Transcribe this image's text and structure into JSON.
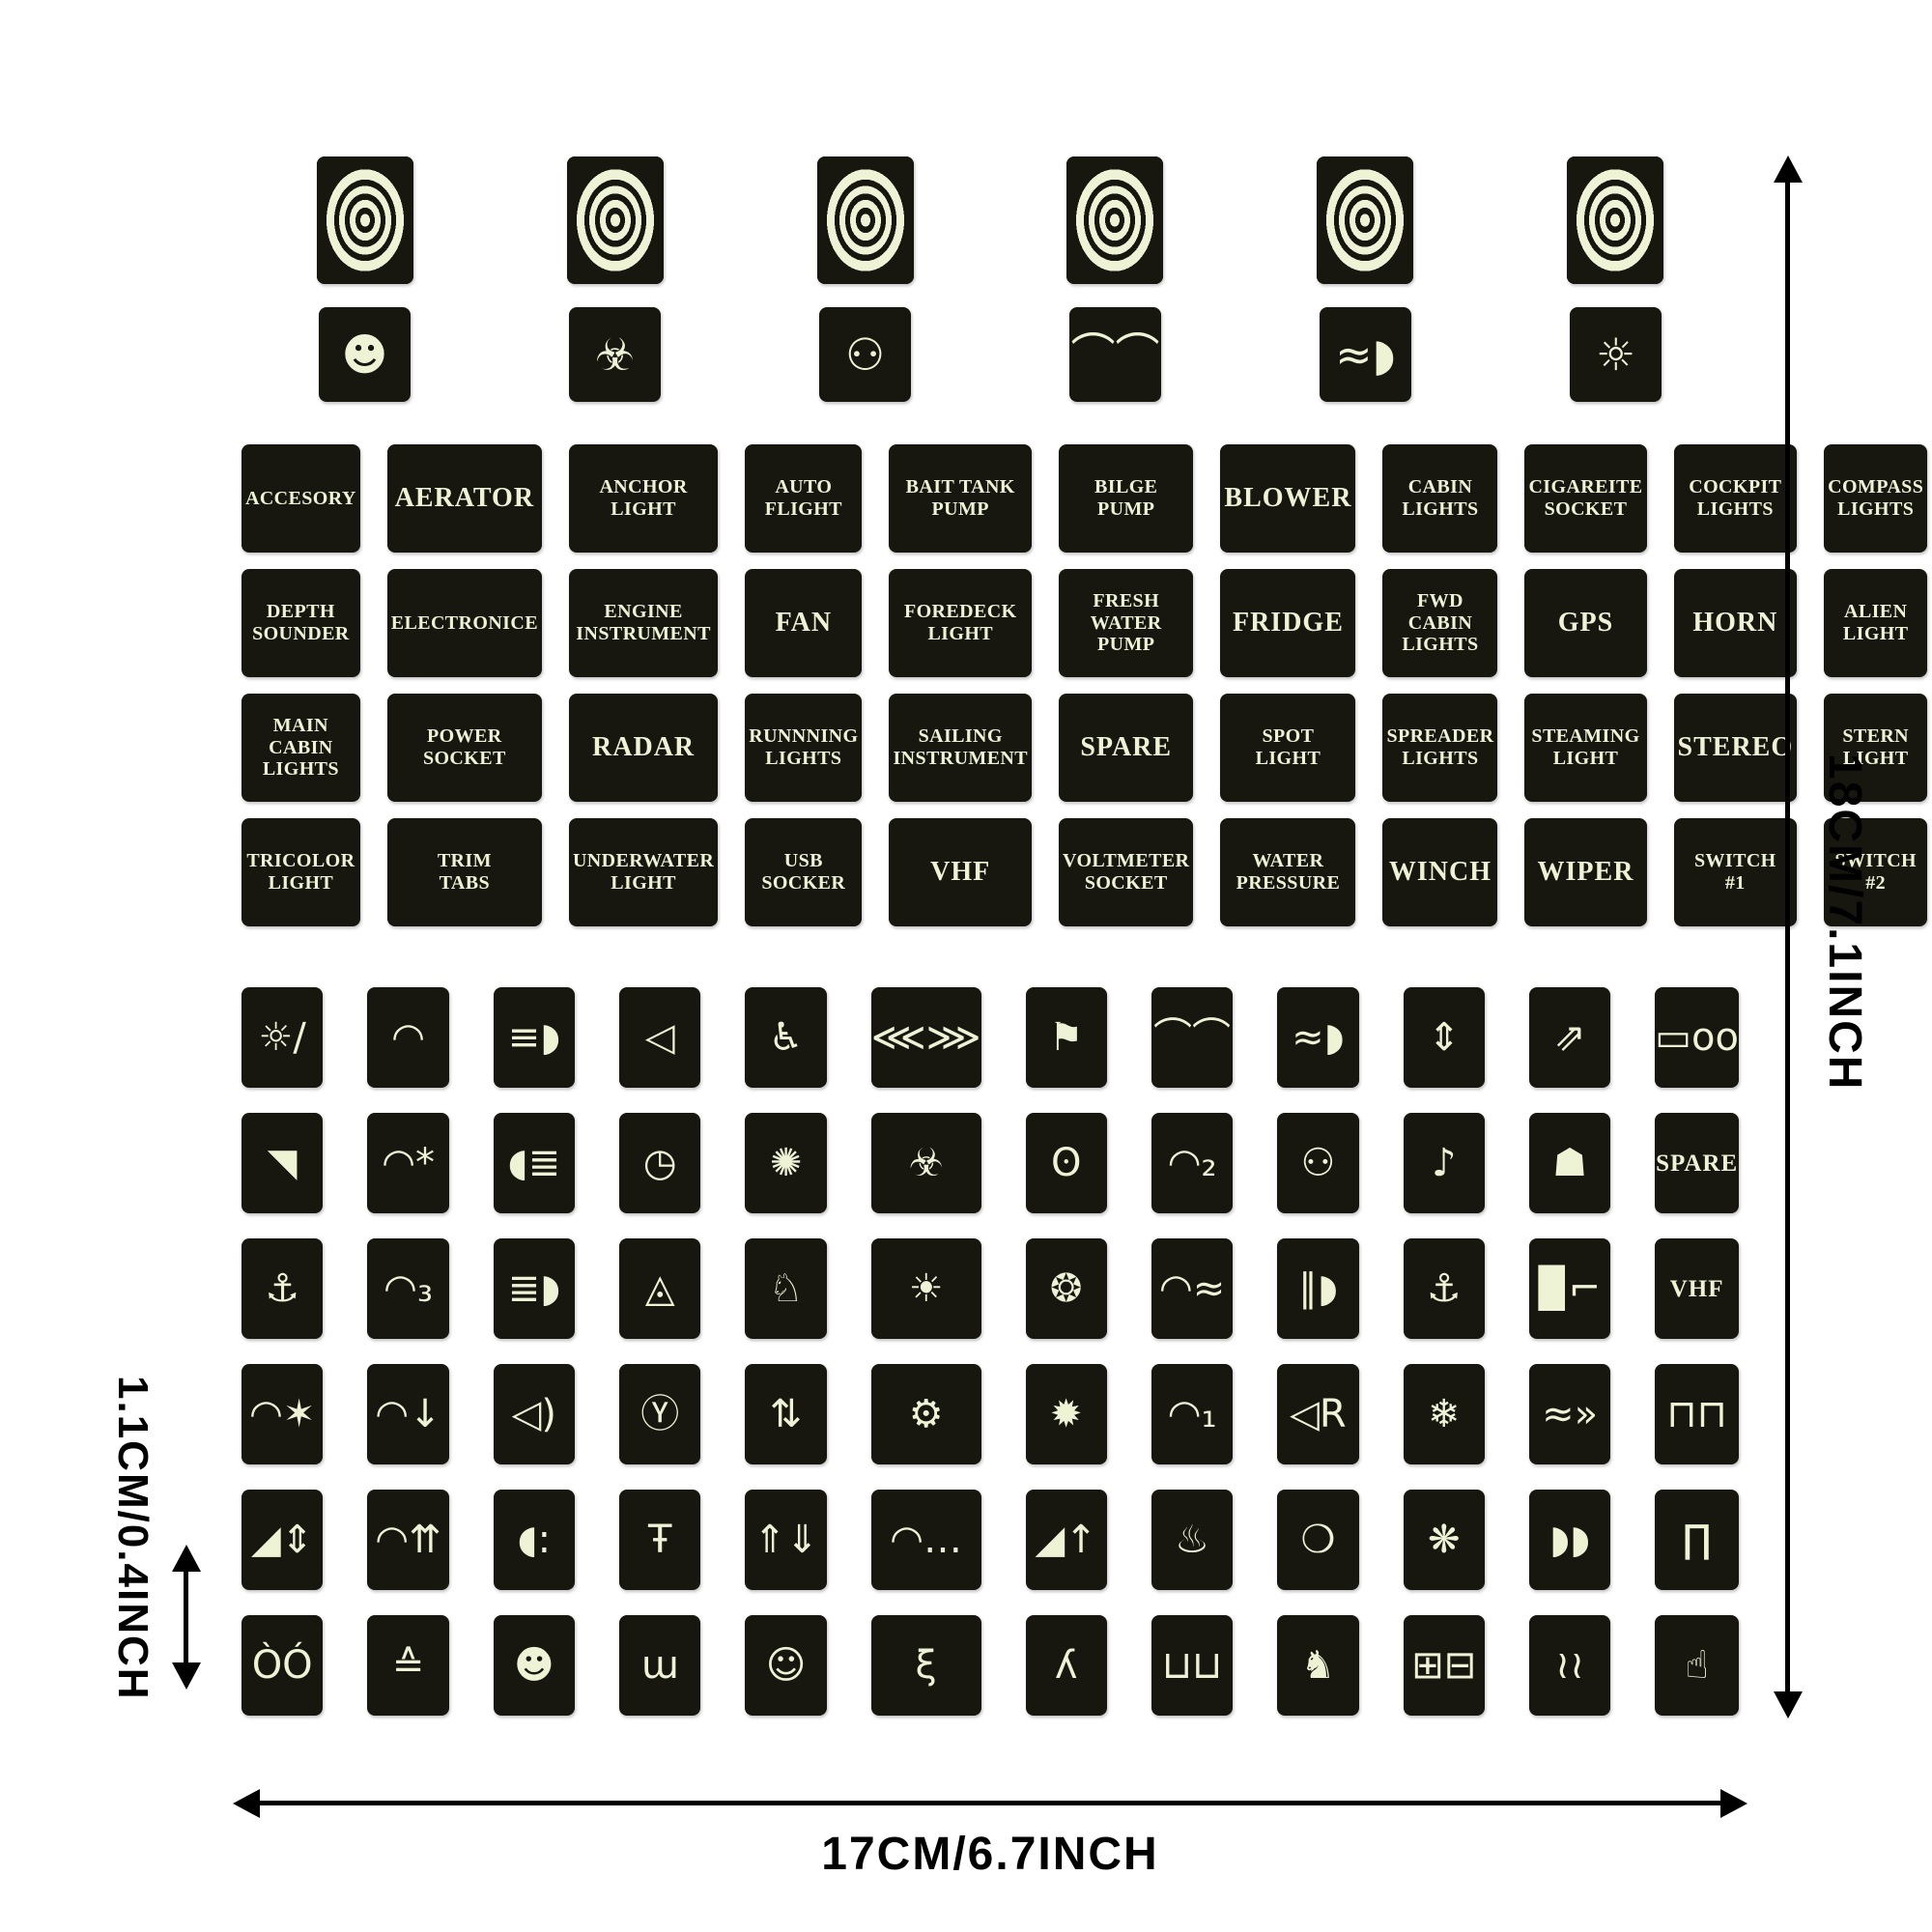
{
  "colors": {
    "background": "#ffffff",
    "sticker": "#171710",
    "glow": "#eef3d6",
    "annotation": "#000000"
  },
  "dims": {
    "height": "18CM/7.1INCH",
    "width": "17CM/6.7INCH",
    "cell": "1.1CM/0.4INCH"
  },
  "sheet": {
    "targets": [
      {
        "name": "bullseye-target-sticker"
      },
      {
        "name": "bullseye-target-sticker"
      },
      {
        "name": "bullseye-target-sticker"
      },
      {
        "name": "bullseye-target-sticker"
      },
      {
        "name": "bullseye-target-sticker"
      },
      {
        "name": "bullseye-target-sticker"
      }
    ],
    "novelty": [
      {
        "name": "gangster-face-icon",
        "glyph": "☻"
      },
      {
        "name": "biohazard-icon",
        "glyph": "☣"
      },
      {
        "name": "alien-icon",
        "glyph": "⚇"
      },
      {
        "name": "wiper-washer-icon",
        "glyph": "⌒⌒"
      },
      {
        "name": "fog-light-icon",
        "glyph": "≈◗"
      },
      {
        "name": "light-dial-icon",
        "glyph": "☼"
      }
    ],
    "labels": [
      "ACCESORY",
      "AERATOR",
      "ANCHOR\nLIGHT",
      "AUTO\nFLIGHT",
      "BAIT TANK\nPUMP",
      "BILGE\nPUMP",
      "BLOWER",
      "CABIN\nLIGHTS",
      "CIGAREITE\nSOCKET",
      "COCKPIT\nLIGHTS",
      "COMPASS\nLIGHTS",
      "DECK\nWASH",
      "DEPTH\nSOUNDER",
      "ELECTRONICE",
      "ENGINE\nINSTRUMENT",
      "FAN",
      "FOREDECK\nLIGHT",
      "FRESH WATER\nPUMP",
      "FRIDGE",
      "FWD CABIN\nLIGHTS",
      "GPS",
      "HORN",
      "ALIEN\nLIGHT",
      "MACERATOR\nPUMP",
      "MAIN CABIN\nLIGHTS",
      "POWER\nSOCKET",
      "RADAR",
      "RUNNNING\nLIGHTS",
      "SAILING\nINSTRUMENT",
      "SPARE",
      "SPOT\nLIGHT",
      "SPREADER\nLIGHTS",
      "STEAMING\nLIGHT",
      "STEREO",
      "STERN\nLIGHT",
      "STROBE\nLIGHT",
      "TRICOLOR\nLIGHT",
      "TRIM\nTABS",
      "UNDERWATER\nLIGHT",
      "USB\nSOCKER",
      "VHF",
      "VOLTMETER\nSOCKET",
      "WATER\nPRESSURE",
      "WINCH",
      "WIPER",
      "SWITCH\n#1",
      "SWITCH\n#2",
      "SWITCH\n#3"
    ],
    "icons": [
      {
        "name": "nav-lights-off-icon",
        "glyph": "☼∕"
      },
      {
        "name": "windshield-wiper-icon",
        "glyph": "◠"
      },
      {
        "name": "headlight-beam-icon",
        "glyph": "≡◗"
      },
      {
        "name": "speaker-icon",
        "glyph": "◁"
      },
      {
        "name": "wheelchair-icon",
        "glyph": "♿"
      },
      {
        "name": "wings-icon",
        "glyph": "⋘⋙"
      },
      {
        "name": "boat-flag-icon",
        "glyph": "⚑"
      },
      {
        "name": "wiper-spray-icon",
        "glyph": "⌒⌒"
      },
      {
        "name": "fog-light-icon",
        "glyph": "≈◗"
      },
      {
        "name": "trim-arrows-icon",
        "glyph": "⇕"
      },
      {
        "name": "outboard-tilt-icon",
        "glyph": "⇗"
      },
      {
        "name": "tow-truck-icon",
        "glyph": "▭oo"
      },
      {
        "name": "sonar-boat-icon",
        "glyph": "◥"
      },
      {
        "name": "wiper-washer-icon",
        "glyph": "◠*"
      },
      {
        "name": "lamp-check-icon",
        "glyph": "◖≣"
      },
      {
        "name": "gauge-icon",
        "glyph": "◷"
      },
      {
        "name": "beacon-icon",
        "glyph": "✺"
      },
      {
        "name": "biohazard-icon",
        "glyph": "☣"
      },
      {
        "name": "bulb-ring-icon",
        "glyph": "ʘ"
      },
      {
        "name": "wiper-delay-2-icon",
        "glyph": "◠₂"
      },
      {
        "name": "alien-icon",
        "glyph": "⚇"
      },
      {
        "name": "music-note-icon",
        "glyph": "♪"
      },
      {
        "name": "turtle-icon",
        "glyph": "☗"
      },
      {
        "name": "spare-text-sticker",
        "glyph": "SPARE",
        "text": true
      },
      {
        "name": "anchor-light-icon",
        "glyph": "⚓"
      },
      {
        "name": "wiper-delay-3-icon",
        "glyph": "◠₃"
      },
      {
        "name": "high-beam-icon",
        "glyph": "≣◗"
      },
      {
        "name": "hazard-triangle-icon",
        "glyph": "◬"
      },
      {
        "name": "rabbit-icon",
        "glyph": "♘"
      },
      {
        "name": "sun-light-icon",
        "glyph": "☀"
      },
      {
        "name": "spreader-light-icon",
        "glyph": "❂"
      },
      {
        "name": "wiper-washpump-icon",
        "glyph": "◠≈"
      },
      {
        "name": "driving-light-icon",
        "glyph": "∥◗"
      },
      {
        "name": "anchor-icon",
        "glyph": "⚓"
      },
      {
        "name": "fuel-pump-icon",
        "glyph": "▉⌐"
      },
      {
        "name": "vhf-text-sticker",
        "glyph": "VHF",
        "text": true
      },
      {
        "name": "grill-light-icon",
        "glyph": "◠✶"
      },
      {
        "name": "wiper-down-icon",
        "glyph": "◠↓"
      },
      {
        "name": "horn-icon",
        "glyph": "◁)"
      },
      {
        "name": "steering-wheel-icon",
        "glyph": "Ⓨ"
      },
      {
        "name": "fluid-level-icon",
        "glyph": "⇅"
      },
      {
        "name": "engine-piston-icon",
        "glyph": "⚙"
      },
      {
        "name": "bulb-rays-icon",
        "glyph": "✹"
      },
      {
        "name": "wiper-delay-1-icon",
        "glyph": "◠₁"
      },
      {
        "name": "air-horn-icon",
        "glyph": "◁R"
      },
      {
        "name": "snowflake-icon",
        "glyph": "❄"
      },
      {
        "name": "lights-fishing-icon",
        "glyph": "≈»"
      },
      {
        "name": "light-bar-icon",
        "glyph": "⊓⊓"
      },
      {
        "name": "boat-trim-icon",
        "glyph": "◢⇕"
      },
      {
        "name": "defroster-icon",
        "glyph": "◠⇈"
      },
      {
        "name": "flood-light-icon",
        "glyph": "◖:"
      },
      {
        "name": "faucet-icon",
        "glyph": "Ŧ"
      },
      {
        "name": "hatch-lift-icon",
        "glyph": "⇑⇓"
      },
      {
        "name": "dome-light-icon",
        "glyph": "◠…"
      },
      {
        "name": "boat-lift-icon",
        "glyph": "◢↑"
      },
      {
        "name": "cabin-heat-icon",
        "glyph": "♨"
      },
      {
        "name": "fog-lamp-down-icon",
        "glyph": "❍"
      },
      {
        "name": "fan-icon",
        "glyph": "❋"
      },
      {
        "name": "dual-headlights-icon",
        "glyph": "◗◗"
      },
      {
        "name": "arch-frame-icon",
        "glyph": "∏"
      },
      {
        "name": "angry-eyes-icon",
        "glyph": "ÒÓ"
      },
      {
        "name": "detective-icon",
        "glyph": "≙"
      },
      {
        "name": "gangster-face-icon",
        "glyph": "☻"
      },
      {
        "name": "mustache-face-icon",
        "glyph": "ɯ"
      },
      {
        "name": "monkey-icon",
        "glyph": "☺"
      },
      {
        "name": "poodle-icon",
        "glyph": "ξ"
      },
      {
        "name": "bigfoot-icon",
        "glyph": "ʎ"
      },
      {
        "name": "beer-mugs-icon",
        "glyph": "⊔⊔"
      },
      {
        "name": "bunny-icon",
        "glyph": "♞"
      },
      {
        "name": "battery-icon",
        "glyph": "⊞⊟"
      },
      {
        "name": "flames-icon",
        "glyph": "≀≀"
      },
      {
        "name": "hand-gesture-icon",
        "glyph": "☝"
      }
    ]
  }
}
